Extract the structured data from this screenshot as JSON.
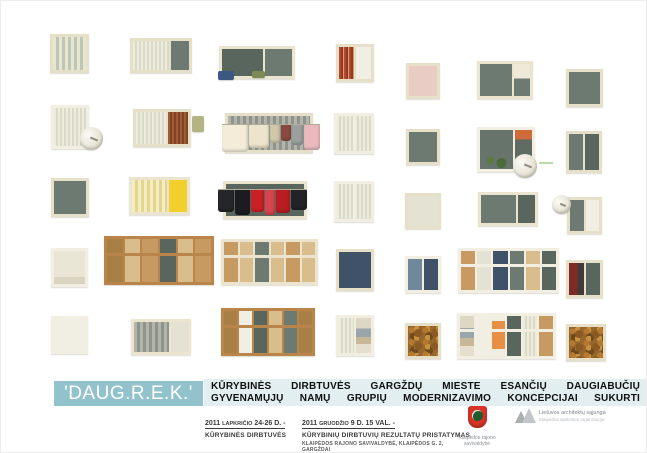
{
  "poster": {
    "title": "'DAUG.R.E.K.'",
    "title_bar_color": "#92c2cc",
    "subtitle_bar_color": "#e3eef0",
    "subtitle_lines": [
      "KŪRYBINĖS DIRBTUVĖS GARGŽDŲ MIESTE ESANČIŲ DAUGIABUČIŲ",
      "GYVENAMŲJŲ NAMŲ GRUPIŲ MODERNIZAVIMO KONCEPCIJAI SUKURTI"
    ]
  },
  "events": [
    {
      "date_year": "2011",
      "date_month": "LAPKRIČIO",
      "date_rest": "24-26 D. -",
      "lines": [
        "KŪRYBINĖS DIRBTUVĖS"
      ]
    },
    {
      "date_year": "2011",
      "date_month": "GRUODŽIO",
      "date_rest": "9 D. 15 VAL. -",
      "lines": [
        "KŪRYBINIŲ DIRBTUVIŲ REZULTATŲ PRISTATYMAS",
        "KLAIPĖDOS RAJONO SAVIVALDYBĖ,   KLAIPĖDOS G. 2, GARGŽDAI"
      ]
    }
  ],
  "logos": [
    {
      "name": "klaipedos-rajono-savivaldybe",
      "caption": "Klaipėdos rajono savivaldybė",
      "color": "#d83426"
    },
    {
      "name": "lietuvos-architektu-sajunga",
      "caption": "Lietuvos architektų sąjunga",
      "subcaption": "Klaipėdos apskrities organizacija",
      "color": "#b3b8bc"
    }
  ],
  "windows": [
    {
      "name": "window-1-1",
      "x": 49,
      "y": 33,
      "w": 39,
      "h": 39,
      "frame": "cream",
      "panes": [
        {
          "f": "folds"
        }
      ]
    },
    {
      "name": "window-1-2",
      "x": 129,
      "y": 37,
      "w": 62,
      "h": 35,
      "frame": "cream",
      "panes": [
        {
          "f": "lace",
          "w": 2
        },
        {
          "f": "dark",
          "w": 1
        }
      ]
    },
    {
      "name": "window-1-3",
      "x": 218,
      "y": 45,
      "w": 76,
      "h": 33,
      "frame": "pale",
      "panes": [
        {
          "f": "dark2",
          "w": 3
        },
        {
          "f": "dark",
          "w": 2
        }
      ],
      "extras": [
        {
          "type": "cloth",
          "x": -4,
          "y": 22,
          "w": 16,
          "h": 9,
          "c": "#3d5880"
        },
        {
          "type": "cloth",
          "x": 30,
          "y": 22,
          "w": 13,
          "h": 7,
          "c": "#7d8a56"
        }
      ]
    },
    {
      "name": "window-1-4",
      "x": 335,
      "y": 43,
      "w": 38,
      "h": 38,
      "frame": "cream",
      "panes": [
        {
          "f": "redfold"
        },
        {
          "f": "white"
        }
      ]
    },
    {
      "name": "window-1-5",
      "x": 405,
      "y": 62,
      "w": 34,
      "h": 36,
      "frame": "cream",
      "panes": [
        {
          "f": "pink"
        }
      ]
    },
    {
      "name": "window-1-6",
      "x": 476,
      "y": 60,
      "w": 56,
      "h": 38,
      "frame": "pale",
      "panes": [
        {
          "f": "dark",
          "w": 2
        },
        {
          "f": "whitedark",
          "w": 1
        }
      ]
    },
    {
      "name": "window-1-7",
      "x": 565,
      "y": 68,
      "w": 37,
      "h": 38,
      "frame": "cream",
      "panes": [
        {
          "f": "dark"
        }
      ]
    },
    {
      "name": "window-2-1",
      "x": 50,
      "y": 104,
      "w": 38,
      "h": 44,
      "frame": "white",
      "panes": [
        {
          "f": "lace"
        }
      ],
      "extras": [
        {
          "type": "dish",
          "x": 26,
          "y": 19,
          "d": 23
        }
      ]
    },
    {
      "name": "window-2-2",
      "x": 132,
      "y": 108,
      "w": 58,
      "h": 38,
      "frame": "cream",
      "panes": [
        {
          "f": "lace",
          "w": 3
        },
        {
          "f": "rust",
          "w": 2
        }
      ],
      "extras": [
        {
          "type": "cloth",
          "x": 56,
          "y": 4,
          "w": 12,
          "h": 16,
          "c": "#b3b383"
        }
      ]
    },
    {
      "name": "window-2-3",
      "x": 224,
      "y": 112,
      "w": 88,
      "h": 40,
      "frame": "cream",
      "panes": [
        {
          "f": "graystripes"
        }
      ],
      "extras": [
        {
          "type": "laundry",
          "x": -6,
          "y": 9,
          "items": [
            {
              "c": "#f3ecd9",
              "w": 26,
              "h": 27
            },
            {
              "c": "#ece4cc",
              "w": 20,
              "h": 23
            },
            {
              "c": "#cfc9a9",
              "w": 10,
              "h": 18
            },
            {
              "c": "#8a4a42",
              "w": 10,
              "h": 16
            },
            {
              "c": "#9aa09e",
              "w": 11,
              "h": 20
            },
            {
              "c": "#e9b9be",
              "w": 16,
              "h": 25
            }
          ]
        }
      ]
    },
    {
      "name": "window-2-4",
      "x": 333,
      "y": 112,
      "w": 40,
      "h": 41,
      "frame": "white",
      "panes": [
        {
          "f": "lace"
        },
        {
          "f": "lace"
        }
      ]
    },
    {
      "name": "window-2-5",
      "x": 405,
      "y": 128,
      "w": 34,
      "h": 36,
      "frame": "cream",
      "panes": [
        {
          "f": "dark"
        }
      ]
    },
    {
      "name": "window-2-6",
      "x": 476,
      "y": 126,
      "w": 58,
      "h": 45,
      "frame": "white",
      "panes": [
        {
          "f": "plants",
          "w": 2
        },
        {
          "f": "orangedoor",
          "w": 1
        }
      ],
      "extras": [
        {
          "type": "dish",
          "x": 33,
          "y": 24,
          "d": 24
        },
        {
          "type": "dash",
          "x": 59,
          "y": 32,
          "w": 14
        }
      ]
    },
    {
      "name": "window-2-7",
      "x": 565,
      "y": 130,
      "w": 36,
      "h": 42,
      "frame": "cream",
      "panes": [
        {
          "f": "dark"
        },
        {
          "f": "dark2"
        }
      ]
    },
    {
      "name": "window-3-1",
      "x": 50,
      "y": 177,
      "w": 38,
      "h": 39,
      "frame": "cream",
      "panes": [
        {
          "f": "dark"
        }
      ]
    },
    {
      "name": "window-3-2",
      "x": 128,
      "y": 176,
      "w": 61,
      "h": 38,
      "frame": "pale",
      "panes": [
        {
          "f": "paleyellow",
          "w": 2
        },
        {
          "f": "yellow",
          "w": 1
        }
      ]
    },
    {
      "name": "window-3-3",
      "x": 222,
      "y": 180,
      "w": 84,
      "h": 38,
      "frame": "pale",
      "panes": [
        {
          "f": "dark2"
        }
      ],
      "extras": [
        {
          "type": "laundry",
          "x": -8,
          "y": 6,
          "items": [
            {
              "c": "#26262a",
              "w": 16,
              "h": 22
            },
            {
              "c": "#1c1c20",
              "w": 15,
              "h": 25
            },
            {
              "c": "#cb2026",
              "w": 13,
              "h": 22
            },
            {
              "c": "#d8444b",
              "w": 10,
              "h": 25
            },
            {
              "c": "#b81d22",
              "w": 14,
              "h": 23
            },
            {
              "c": "#232327",
              "w": 16,
              "h": 20
            }
          ]
        }
      ]
    },
    {
      "name": "window-3-4",
      "x": 333,
      "y": 180,
      "w": 40,
      "h": 41,
      "frame": "white",
      "panes": [
        {
          "f": "lace"
        },
        {
          "f": "lace"
        }
      ]
    },
    {
      "name": "window-3-5",
      "x": 404,
      "y": 192,
      "w": 36,
      "h": 36,
      "frame": "cream",
      "panes": [
        {
          "f": "lace2"
        }
      ]
    },
    {
      "name": "window-3-6",
      "x": 477,
      "y": 191,
      "w": 60,
      "h": 34,
      "frame": "pale",
      "panes": [
        {
          "f": "dark",
          "w": 2
        },
        {
          "f": "dark2",
          "w": 1
        }
      ]
    },
    {
      "name": "window-3-7",
      "x": 566,
      "y": 196,
      "w": 35,
      "h": 37,
      "frame": "cream",
      "panes": [
        {
          "f": "dark"
        },
        {
          "f": "white"
        }
      ],
      "extras": [
        {
          "type": "dish",
          "x": -18,
          "y": -5,
          "d": 19
        }
      ]
    },
    {
      "name": "window-4-1",
      "x": 50,
      "y": 247,
      "w": 37,
      "h": 39,
      "frame": "white",
      "panes": [
        {
          "f": "blind"
        }
      ]
    },
    {
      "name": "window-4-2",
      "x": 103,
      "y": 235,
      "w": 110,
      "h": 49,
      "frame": "wood",
      "rail": true,
      "panes": [
        {
          "f": "wooddark"
        },
        {
          "f": "woodlight"
        },
        {
          "f": "wood"
        },
        {
          "f": "dark2"
        },
        {
          "f": "woodlight"
        },
        {
          "f": "wood"
        }
      ]
    },
    {
      "name": "window-4-3",
      "x": 220,
      "y": 238,
      "w": 97,
      "h": 46,
      "frame": "pale",
      "rail": true,
      "panes": [
        {
          "f": "wood"
        },
        {
          "f": "woodlight"
        },
        {
          "f": "dark"
        },
        {
          "f": "woodlight"
        },
        {
          "f": "wood"
        },
        {
          "f": "woodlight"
        }
      ]
    },
    {
      "name": "window-4-4",
      "x": 335,
      "y": 248,
      "w": 38,
      "h": 42,
      "frame": "cream",
      "panes": [
        {
          "f": "blue"
        }
      ]
    },
    {
      "name": "window-4-5",
      "x": 404,
      "y": 255,
      "w": 36,
      "h": 37,
      "frame": "white",
      "panes": [
        {
          "f": "sky"
        },
        {
          "f": "blue"
        }
      ]
    },
    {
      "name": "window-4-6",
      "x": 457,
      "y": 247,
      "w": 101,
      "h": 45,
      "frame": "white",
      "rail": true,
      "panes": [
        {
          "f": "wood"
        },
        {
          "f": "lace2"
        },
        {
          "f": "blue"
        },
        {
          "f": "dark"
        },
        {
          "f": "woodlight"
        },
        {
          "f": "dark2"
        }
      ]
    },
    {
      "name": "window-4-7",
      "x": 565,
      "y": 259,
      "w": 37,
      "h": 38,
      "frame": "cream",
      "panes": [
        {
          "f": "redcurtain"
        },
        {
          "f": "dark2"
        }
      ]
    },
    {
      "name": "window-5-1",
      "x": 50,
      "y": 315,
      "w": 37,
      "h": 38,
      "frame": "white",
      "panes": [
        {
          "f": "white"
        }
      ]
    },
    {
      "name": "window-5-2",
      "x": 130,
      "y": 318,
      "w": 60,
      "h": 36,
      "frame": "pale",
      "panes": [
        {
          "f": "graystripes",
          "w": 2
        },
        {
          "f": "lace2",
          "w": 1
        }
      ]
    },
    {
      "name": "window-5-3",
      "x": 220,
      "y": 307,
      "w": 94,
      "h": 48,
      "frame": "wood",
      "rail": true,
      "panes": [
        {
          "f": "wooddark"
        },
        {
          "f": "white"
        },
        {
          "f": "dark2"
        },
        {
          "f": "woodlight"
        },
        {
          "f": "dark"
        },
        {
          "f": "wooddark"
        }
      ]
    },
    {
      "name": "window-5-4",
      "x": 335,
      "y": 314,
      "w": 38,
      "h": 41,
      "frame": "white",
      "panes": [
        {
          "f": "lace"
        },
        {
          "f": "clutter"
        }
      ]
    },
    {
      "name": "window-5-5",
      "x": 404,
      "y": 322,
      "w": 36,
      "h": 36,
      "frame": "cream",
      "panes": [
        {
          "f": "foliage"
        }
      ]
    },
    {
      "name": "window-5-6",
      "x": 456,
      "y": 312,
      "w": 99,
      "h": 46,
      "frame": "white",
      "rail": true,
      "panes": [
        {
          "f": "clutter"
        },
        {
          "f": "white"
        },
        {
          "f": "towel"
        },
        {
          "f": "dark2"
        },
        {
          "f": "lace"
        },
        {
          "f": "wood"
        }
      ]
    },
    {
      "name": "window-5-7",
      "x": 565,
      "y": 323,
      "w": 40,
      "h": 37,
      "frame": "cream",
      "panes": [
        {
          "f": "foliage"
        }
      ]
    }
  ]
}
